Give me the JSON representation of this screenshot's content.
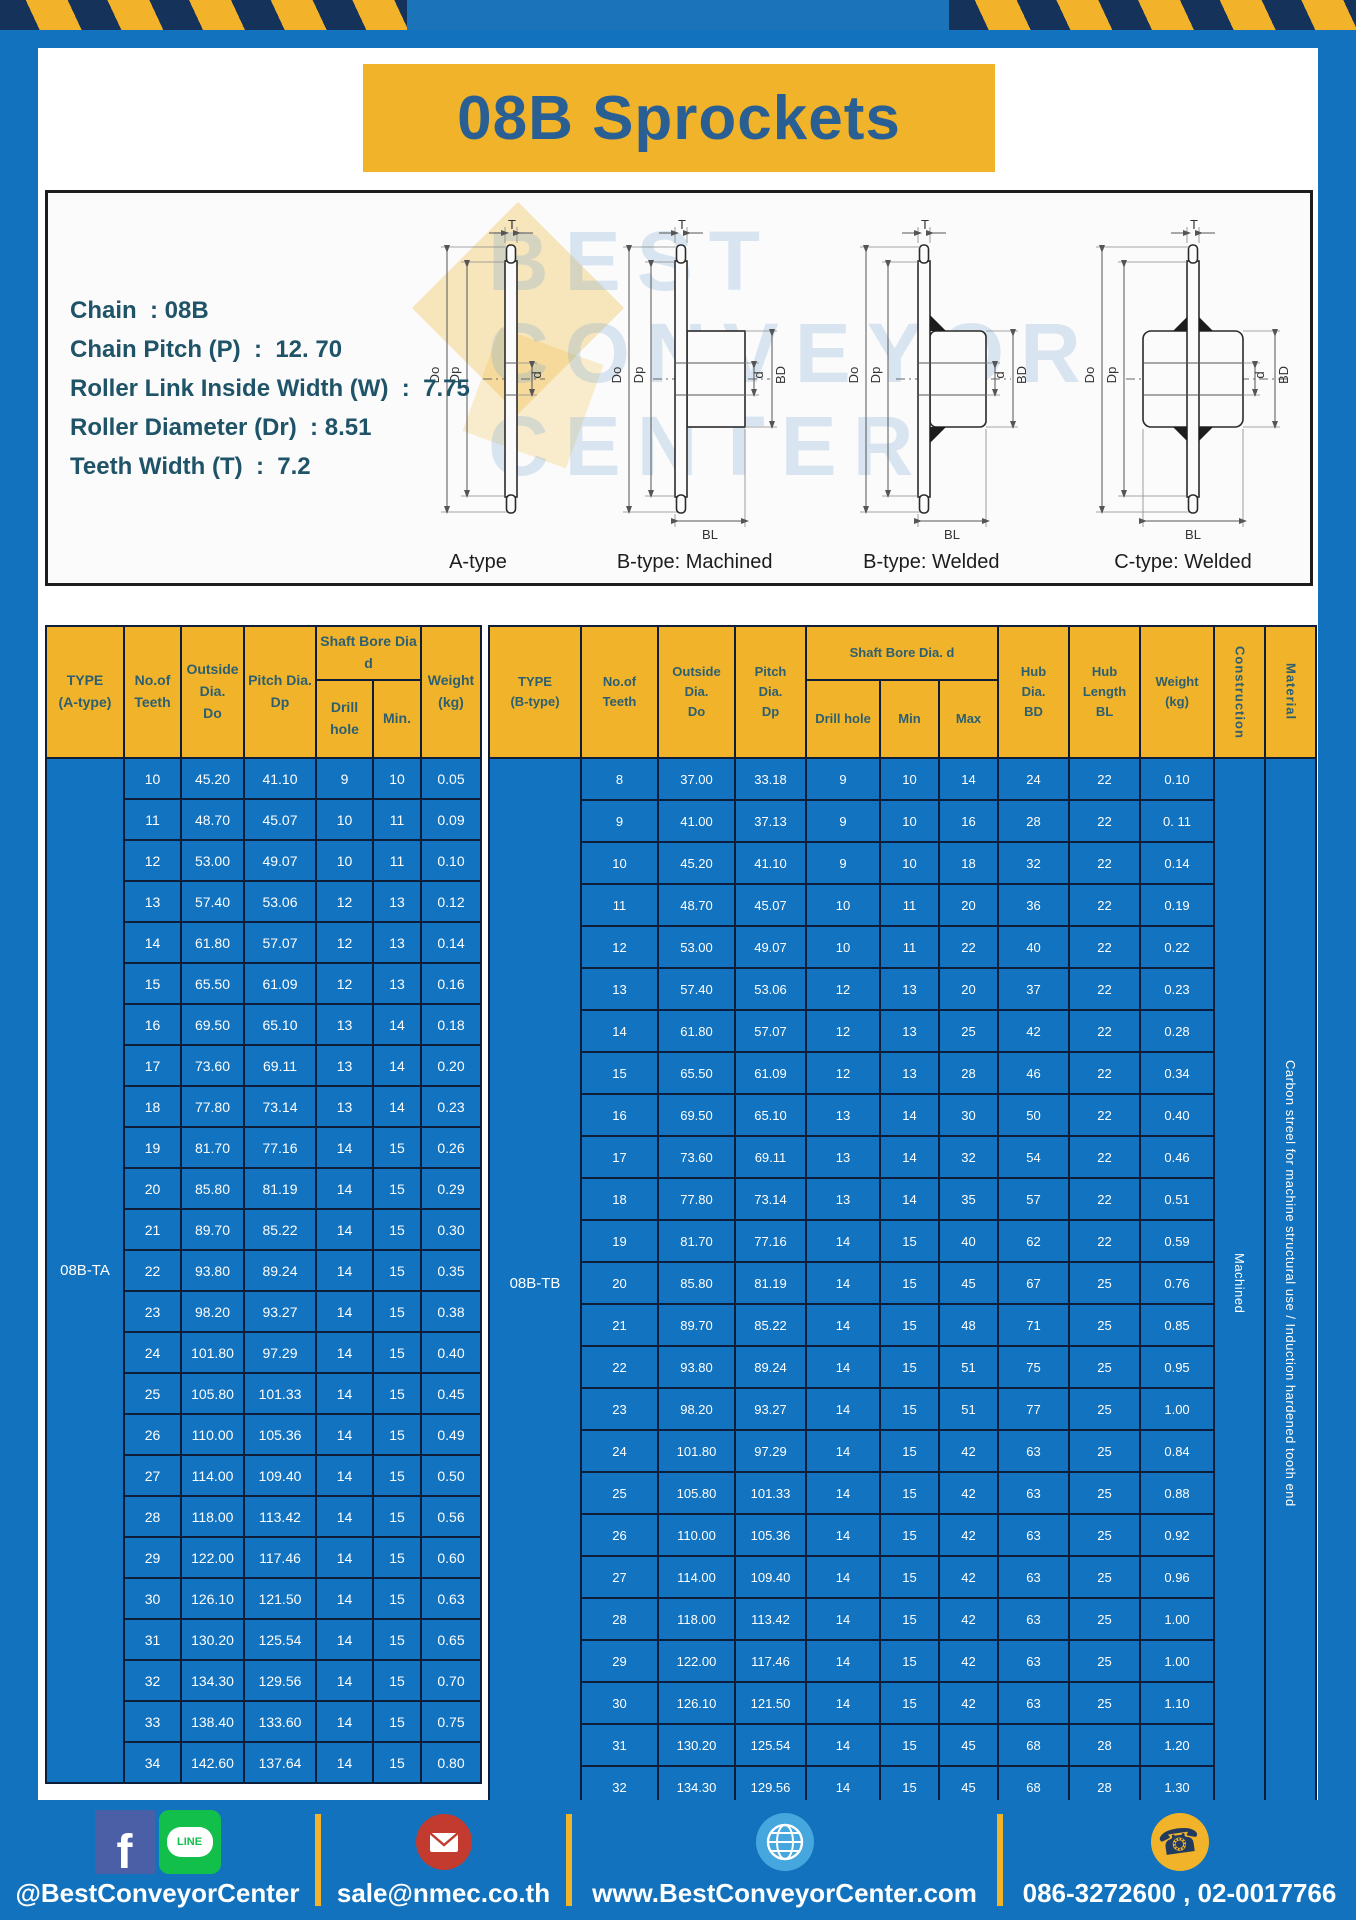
{
  "title": "08B Sprockets",
  "colors": {
    "page_blue": "#1272bd",
    "table_blue": "#1273c0",
    "accent_yellow": "#f0b32a",
    "border_navy": "#0e1e38",
    "header_text": "#2d5f70",
    "title_text": "#2a5f94"
  },
  "specs": [
    "Chain  : 08B",
    "Chain Pitch (P)  :  12. 70",
    "Roller Link Inside Width (W)  :  7.75",
    "Roller Diameter (Dr)  : 8.51",
    "Teeth Width (T)  :  7.2"
  ],
  "watermark": [
    "BEST",
    "CONVEYOR",
    "CENTER"
  ],
  "diagram": {
    "labels": [
      "A-type",
      "B-type: Machined",
      "B-type: Welded",
      "C-type: Welded"
    ],
    "dims": {
      "t": "T",
      "do": "Do",
      "dp": "Dp",
      "d": "d",
      "bd": "BD",
      "bl": "BL"
    }
  },
  "table_a": {
    "type_label": "08B-TA",
    "headers": {
      "type": "TYPE\n(A-type)",
      "teeth": "No.of\nTeeth",
      "outside": "Outside\nDia.\nDo",
      "pitch": "Pitch Dia.\nDp",
      "shaft_bore": "Shaft Bore Dia d",
      "drill": "Drill hole",
      "min": "Min.",
      "weight": "Weight\n(kg)"
    },
    "rows": [
      [
        "10",
        "45.20",
        "41.10",
        "9",
        "10",
        "0.05"
      ],
      [
        "11",
        "48.70",
        "45.07",
        "10",
        "11",
        "0.09"
      ],
      [
        "12",
        "53.00",
        "49.07",
        "10",
        "11",
        "0.10"
      ],
      [
        "13",
        "57.40",
        "53.06",
        "12",
        "13",
        "0.12"
      ],
      [
        "14",
        "61.80",
        "57.07",
        "12",
        "13",
        "0.14"
      ],
      [
        "15",
        "65.50",
        "61.09",
        "12",
        "13",
        "0.16"
      ],
      [
        "16",
        "69.50",
        "65.10",
        "13",
        "14",
        "0.18"
      ],
      [
        "17",
        "73.60",
        "69.11",
        "13",
        "14",
        "0.20"
      ],
      [
        "18",
        "77.80",
        "73.14",
        "13",
        "14",
        "0.23"
      ],
      [
        "19",
        "81.70",
        "77.16",
        "14",
        "15",
        "0.26"
      ],
      [
        "20",
        "85.80",
        "81.19",
        "14",
        "15",
        "0.29"
      ],
      [
        "21",
        "89.70",
        "85.22",
        "14",
        "15",
        "0.30"
      ],
      [
        "22",
        "93.80",
        "89.24",
        "14",
        "15",
        "0.35"
      ],
      [
        "23",
        "98.20",
        "93.27",
        "14",
        "15",
        "0.38"
      ],
      [
        "24",
        "101.80",
        "97.29",
        "14",
        "15",
        "0.40"
      ],
      [
        "25",
        "105.80",
        "101.33",
        "14",
        "15",
        "0.45"
      ],
      [
        "26",
        "110.00",
        "105.36",
        "14",
        "15",
        "0.49"
      ],
      [
        "27",
        "114.00",
        "109.40",
        "14",
        "15",
        "0.50"
      ],
      [
        "28",
        "118.00",
        "113.42",
        "14",
        "15",
        "0.56"
      ],
      [
        "29",
        "122.00",
        "117.46",
        "14",
        "15",
        "0.60"
      ],
      [
        "30",
        "126.10",
        "121.50",
        "14",
        "15",
        "0.63"
      ],
      [
        "31",
        "130.20",
        "125.54",
        "14",
        "15",
        "0.65"
      ],
      [
        "32",
        "134.30",
        "129.56",
        "14",
        "15",
        "0.70"
      ],
      [
        "33",
        "138.40",
        "133.60",
        "14",
        "15",
        "0.75"
      ],
      [
        "34",
        "142.60",
        "137.64",
        "14",
        "15",
        "0.80"
      ]
    ]
  },
  "table_b": {
    "type_label": "08B-TB",
    "headers": {
      "type": "TYPE\n(B-type)",
      "teeth": "No.of\nTeeth",
      "outside": "Outside\nDia.\nDo",
      "pitch": "Pitch\nDia.\nDp",
      "shaft_bore": "Shaft Bore Dia. d",
      "drill": "Drill hole",
      "min": "Min",
      "max": "Max",
      "hub_dia": "Hub\nDia.\nBD",
      "hub_len": "Hub\nLength\nBL",
      "weight": "Weight\n(kg)",
      "construction": "Construction",
      "material": "Material"
    },
    "merged_right": [
      {
        "name": "construction-value",
        "text": "Machined"
      },
      {
        "name": "material-value",
        "text": "Carbon streel for machine structural use / Induction hardened tooth end"
      }
    ],
    "rows": [
      [
        "8",
        "37.00",
        "33.18",
        "9",
        "10",
        "14",
        "24",
        "22",
        "0.10"
      ],
      [
        "9",
        "41.00",
        "37.13",
        "9",
        "10",
        "16",
        "28",
        "22",
        "0. 11"
      ],
      [
        "10",
        "45.20",
        "41.10",
        "9",
        "10",
        "18",
        "32",
        "22",
        "0.14"
      ],
      [
        "11",
        "48.70",
        "45.07",
        "10",
        "11",
        "20",
        "36",
        "22",
        "0.19"
      ],
      [
        "12",
        "53.00",
        "49.07",
        "10",
        "11",
        "22",
        "40",
        "22",
        "0.22"
      ],
      [
        "13",
        "57.40",
        "53.06",
        "12",
        "13",
        "20",
        "37",
        "22",
        "0.23"
      ],
      [
        "14",
        "61.80",
        "57.07",
        "12",
        "13",
        "25",
        "42",
        "22",
        "0.28"
      ],
      [
        "15",
        "65.50",
        "61.09",
        "12",
        "13",
        "28",
        "46",
        "22",
        "0.34"
      ],
      [
        "16",
        "69.50",
        "65.10",
        "13",
        "14",
        "30",
        "50",
        "22",
        "0.40"
      ],
      [
        "17",
        "73.60",
        "69.11",
        "13",
        "14",
        "32",
        "54",
        "22",
        "0.46"
      ],
      [
        "18",
        "77.80",
        "73.14",
        "13",
        "14",
        "35",
        "57",
        "22",
        "0.51"
      ],
      [
        "19",
        "81.70",
        "77.16",
        "14",
        "15",
        "40",
        "62",
        "22",
        "0.59"
      ],
      [
        "20",
        "85.80",
        "81.19",
        "14",
        "15",
        "45",
        "67",
        "25",
        "0.76"
      ],
      [
        "21",
        "89.70",
        "85.22",
        "14",
        "15",
        "48",
        "71",
        "25",
        "0.85"
      ],
      [
        "22",
        "93.80",
        "89.24",
        "14",
        "15",
        "51",
        "75",
        "25",
        "0.95"
      ],
      [
        "23",
        "98.20",
        "93.27",
        "14",
        "15",
        "51",
        "77",
        "25",
        "1.00"
      ],
      [
        "24",
        "101.80",
        "97.29",
        "14",
        "15",
        "42",
        "63",
        "25",
        "0.84"
      ],
      [
        "25",
        "105.80",
        "101.33",
        "14",
        "15",
        "42",
        "63",
        "25",
        "0.88"
      ],
      [
        "26",
        "110.00",
        "105.36",
        "14",
        "15",
        "42",
        "63",
        "25",
        "0.92"
      ],
      [
        "27",
        "114.00",
        "109.40",
        "14",
        "15",
        "42",
        "63",
        "25",
        "0.96"
      ],
      [
        "28",
        "118.00",
        "113.42",
        "14",
        "15",
        "42",
        "63",
        "25",
        "1.00"
      ],
      [
        "29",
        "122.00",
        "117.46",
        "14",
        "15",
        "42",
        "63",
        "25",
        "1.00"
      ],
      [
        "30",
        "126.10",
        "121.50",
        "14",
        "15",
        "42",
        "63",
        "25",
        "1.10"
      ],
      [
        "31",
        "130.20",
        "125.54",
        "14",
        "15",
        "45",
        "68",
        "28",
        "1.20"
      ],
      [
        "32",
        "134.30",
        "129.56",
        "14",
        "15",
        "45",
        "68",
        "28",
        "1.30"
      ]
    ]
  },
  "footer": {
    "facebook_f": "f",
    "line_label": "LINE",
    "phone_glyph": "☎",
    "social": "@BestConveyorCenter",
    "email": "sale@nmec.co.th",
    "website": "www.BestConveyorCenter.com",
    "phone": "086-3272600 , 02-0017766"
  }
}
